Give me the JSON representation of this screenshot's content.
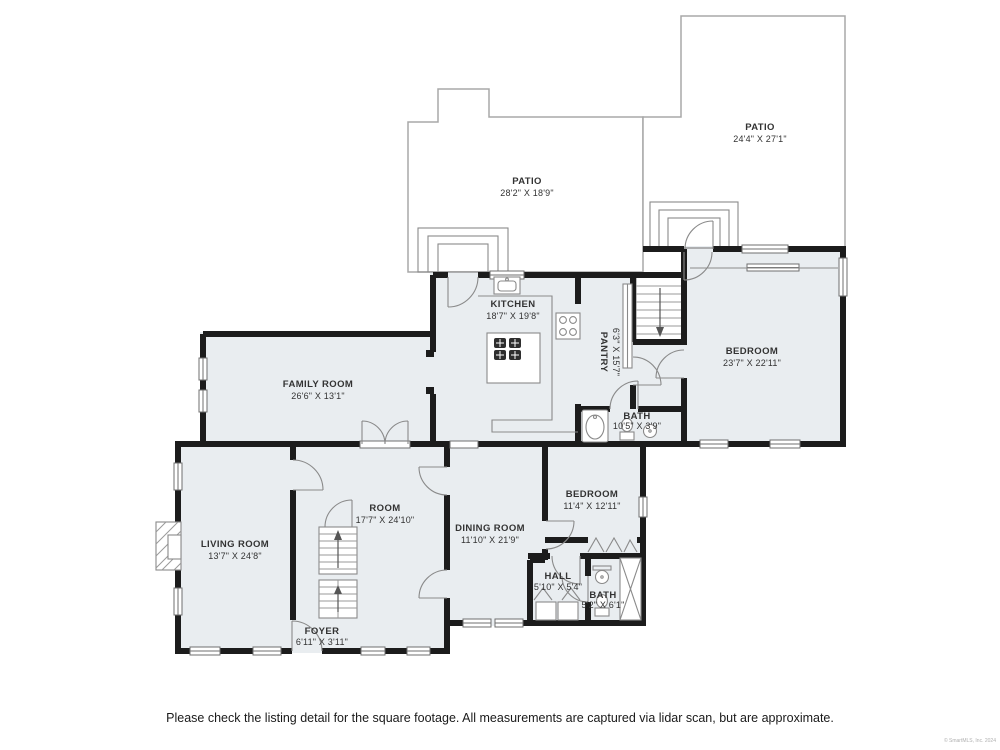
{
  "page": {
    "footer_disclaimer": "Please check the listing detail for the square footage. All measurements are captured via lidar scan, but are approximate.",
    "copyright": "© SmartMLS, Inc. 2024"
  },
  "colors": {
    "wall": "#1c1c1c",
    "room": "#e9edf0",
    "patio_outline": "#a8a8a8",
    "detail": "#8a8a8a",
    "label": "#333333",
    "footer": "#1a1a1a",
    "copyright": "#b0b0b0"
  },
  "rooms": {
    "patio_left": {
      "name": "PATIO",
      "dims": "28'2\" X 18'9\""
    },
    "patio_right": {
      "name": "PATIO",
      "dims": "24'4\" X 27'1\""
    },
    "kitchen": {
      "name": "KITCHEN",
      "dims": "18'7\" X 19'8\""
    },
    "pantry": {
      "name": "PANTRY",
      "dims": "6'3\" X 15'7\""
    },
    "bedroom_primary": {
      "name": "BEDROOM",
      "dims": "23'7\" X 22'11\""
    },
    "family_room": {
      "name": "FAMILY ROOM",
      "dims": "26'6\" X 13'1\""
    },
    "bath_upper": {
      "name": "BATH",
      "dims": "10'5\" X 3'9\""
    },
    "bedroom_second": {
      "name": "BEDROOM",
      "dims": "11'4\" X 12'11\""
    },
    "room": {
      "name": "ROOM",
      "dims": "17'7\" X 24'10\""
    },
    "living_room": {
      "name": "LIVING ROOM",
      "dims": "13'7\" X 24'8\""
    },
    "dining_room": {
      "name": "DINING ROOM",
      "dims": "11'10\" X 21'9\""
    },
    "hall": {
      "name": "HALL",
      "dims": "5'10\" X 5'4\""
    },
    "bath_lower": {
      "name": "BATH",
      "dims": "5'2\" X 6'1\""
    },
    "foyer": {
      "name": "FOYER",
      "dims": "6'11\" X 3'11\""
    }
  }
}
